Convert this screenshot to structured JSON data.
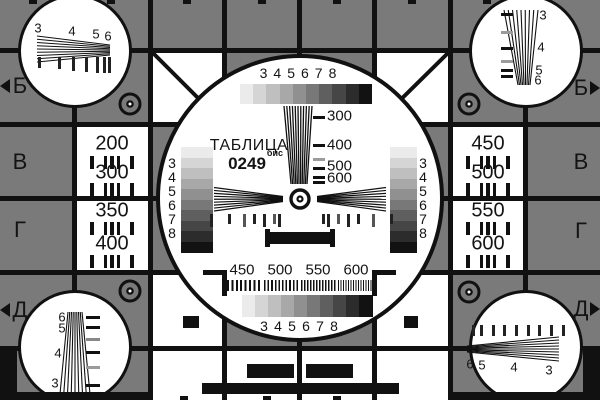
{
  "title": {
    "line1": "ТАБЛИЦА",
    "number": "0249",
    "suffix": "бис"
  },
  "edge_rows": {
    "left": [
      {
        "label": "Б",
        "arrow": true
      },
      {
        "label": "В",
        "arrow": false
      },
      {
        "label": "Г",
        "arrow": false
      },
      {
        "label": "Д",
        "arrow": true
      }
    ],
    "right": [
      {
        "label": "Б",
        "arrow": true
      },
      {
        "label": "В",
        "arrow": false
      },
      {
        "label": "Г",
        "arrow": false
      },
      {
        "label": "Д",
        "arrow": true
      }
    ]
  },
  "left_column_numbers": [
    "200",
    "300",
    "350",
    "400"
  ],
  "right_column_numbers": [
    "450",
    "500",
    "550",
    "600"
  ],
  "grayscale_step_labels": [
    "3",
    "4",
    "5",
    "6",
    "7",
    "8"
  ],
  "grayscale_shades": [
    "#ebebeb",
    "#d5d5d5",
    "#bfbfbf",
    "#a8a8a8",
    "#909090",
    "#787878",
    "#5f5f5f",
    "#464646",
    "#2c2c2c",
    "#121212"
  ],
  "center_frequency_ticks": [
    "300",
    "400",
    "500",
    "600"
  ],
  "bottom_frequency_scale": [
    "450",
    "500",
    "550",
    "600"
  ],
  "corner_wedge_labels": {
    "top_left": [
      "3",
      "4",
      "5",
      "6"
    ],
    "top_right": [
      "3",
      "4",
      "5",
      "6"
    ],
    "bottom_left": [
      "6",
      "5",
      "4",
      "3"
    ],
    "bottom_right": [
      "6",
      "5",
      "4",
      "3"
    ]
  },
  "colors": {
    "background": "#7a7a7a",
    "ink": "#111111",
    "white": "#ffffff",
    "muted_tick": "#9b9b9b"
  }
}
